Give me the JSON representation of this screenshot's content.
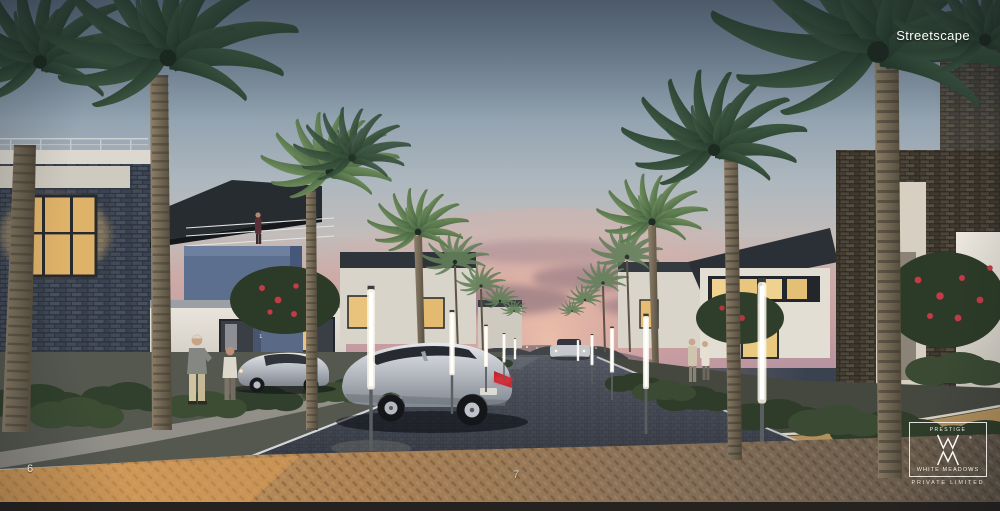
{
  "page": {
    "caption": "Streetscape",
    "page_number_left": "6",
    "page_number_center": "7"
  },
  "logo": {
    "brand": "PRESTIGE",
    "registered_mark": "®",
    "name": "WHITE MEADOWS",
    "suffix": "PRIVATE  LIMITED"
  },
  "scene": {
    "address_marker": "1",
    "colors": {
      "sky_top": "#6b7d92",
      "sky_mid": "#aeb8bf",
      "sunset_pink": "#ccaaa6",
      "cloud_mauve": "#7c6577",
      "palm_dark": "#27402f",
      "palm_light": "#6d8b5a",
      "stone_cool": "#3e4552",
      "stone_warm": "#4a443a",
      "wall_white": "#e5e1d8",
      "wall_blue": "#5d6f8f",
      "window_warm": "#eac67f",
      "road_cobble": "#383d47",
      "paver_amber": "#c9965c",
      "lamp_glow": "#fbf7e6",
      "car_silver": "#c9ccd1",
      "taillight_red": "#c0242e"
    }
  }
}
